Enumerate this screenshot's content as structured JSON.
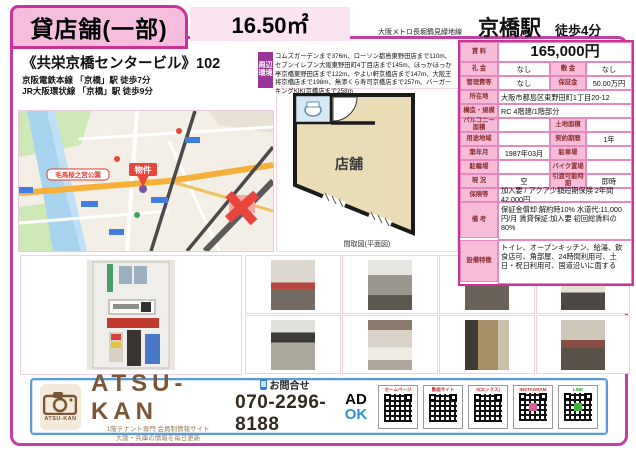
{
  "header": {
    "title": "貸店舗(一部)",
    "area": "16.50㎡",
    "metro_line": "大阪メトロ長堀鶴見緑地線",
    "station": "京橋駅",
    "walk": "徒歩4分"
  },
  "building": {
    "name": "《共栄京橋センタービル》102",
    "rail1": "京阪電鉄本線 「京橋」駅 徒歩7分",
    "rail2": "JR大阪環状線 「京橋」駅 徒歩9分"
  },
  "surroundings": {
    "tab_top": "周辺",
    "tab_bottom": "環境",
    "text": "コムズガーデンまで376m、ローソン都島東野田店まで110m、セブンイレブン大阪東野田町4丁目店まで145m、ほっかほっか亭京橋東野田店まで122m、やよい軒京橋店まで147m、大阪王将京橋店まで198m、無添くら寿司京橋店まで257m、バーガーキングKIKI京橋店まで258m"
  },
  "map": {
    "property_label": "物件",
    "park_label": "毛馬桜之宮公園"
  },
  "floorplan": {
    "room_label": "店舗",
    "caption": "間取図(平面図)"
  },
  "table": {
    "rent_label": "賃 料",
    "rent_value": "165,000円",
    "row_reikin": {
      "l1": "礼 金",
      "v1": "なし",
      "l2": "敷 金",
      "v2": "なし"
    },
    "row_kanri": {
      "l1": "管理費等",
      "v1": "なし",
      "l2": "保証金",
      "v2": "50.00万円"
    },
    "row_address": {
      "l": "所在地",
      "v": "大阪市都島区東野田町1丁目20-12"
    },
    "row_structure": {
      "l": "構造・規模",
      "v": "RC 4階建/1階部分"
    },
    "row_balcony": {
      "l1": "バルコニー面積",
      "v1": "",
      "l2": "土地面積",
      "v2": ""
    },
    "row_youto": {
      "l1": "用途地域",
      "v1": "",
      "l2": "契約期間",
      "v2": "1年"
    },
    "row_built": {
      "l1": "築年月",
      "v1": "1987年03月",
      "l2": "駐車場",
      "v2": ""
    },
    "row_bicycle": {
      "l1": "駐輪場",
      "v1": "",
      "l2": "バイク置場",
      "v2": ""
    },
    "row_status": {
      "l1": "現 況",
      "v1": "空",
      "l2": "引渡可能時期",
      "v2": "即時"
    },
    "row_insurance": {
      "l": "保険等",
      "v": "加入要 / アクア少額短期保険 2年間 42,000円"
    },
    "row_notes": {
      "l": "備 考",
      "v": "保証金償却:解約時10% 水道代:11,000円/月 賃貸保証:加入要 初回総賃料の80%"
    },
    "row_features": {
      "l": "設備特徴",
      "v": "トイレ、オープンキッチン、給湯、飲食店可、角部屋、24時間利用可、土日・祝日利用可、国道沿いに面する"
    }
  },
  "footer": {
    "logo_text": "ATSU-KAN",
    "brand": "ATSU-KAN",
    "tagline1": "1階テナント専門 会員制情報サイト",
    "tagline2": "大阪・兵庫の情報を毎日更新",
    "contact_label": "お問合せ",
    "phone": "070-2296-8188",
    "ad": "AD",
    "ok": "OK",
    "qr_labels": [
      "ホームページ",
      "動画サイト",
      "X(エックス)",
      "INSTAGRAM",
      "LINE"
    ]
  }
}
